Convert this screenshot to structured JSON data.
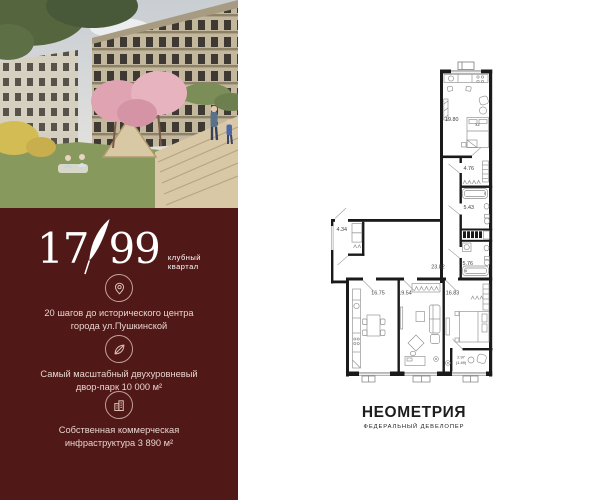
{
  "brand": {
    "logo_left": "17",
    "logo_right": "99",
    "logo_tag1": "клубный",
    "logo_tag2": "квартал",
    "features": [
      {
        "icon": "location-pin-icon",
        "line1": "20 шагов до исторического центра",
        "line2": "города ул.Пушкинской"
      },
      {
        "icon": "leaf-icon",
        "line1": "Самый масштабный двухуровневый",
        "line2": "двор-парк 10 000 м²"
      },
      {
        "icon": "buildings-icon",
        "line1": "Собственная коммерческая",
        "line2": "инфраструктура 3 890 м²"
      }
    ],
    "colors": {
      "panel_bg": "#511818",
      "text": "#e7d4cd",
      "logo": "#ffffff"
    }
  },
  "plan": {
    "labels": {
      "room_top": "19.80",
      "wardrobe": "4.76",
      "bath1": "5.43",
      "bath2": "5.76",
      "hall": "23.82",
      "storage": "4.34",
      "kitchen": "16.75",
      "living": "19.54",
      "bedroom": "16.83",
      "balcony": "2.97",
      "balcony_reduced": "(1.49)",
      "bed": "х2"
    },
    "colors": {
      "walls": "#1a1a1a",
      "furniture": "#8f8f8f",
      "labels": "#3f3f3f"
    }
  },
  "developer": {
    "name": "НЕОМЕТРИЯ",
    "tagline": "ФЕДЕРАЛЬНЫЙ ДЕВЕЛОПЕР"
  }
}
